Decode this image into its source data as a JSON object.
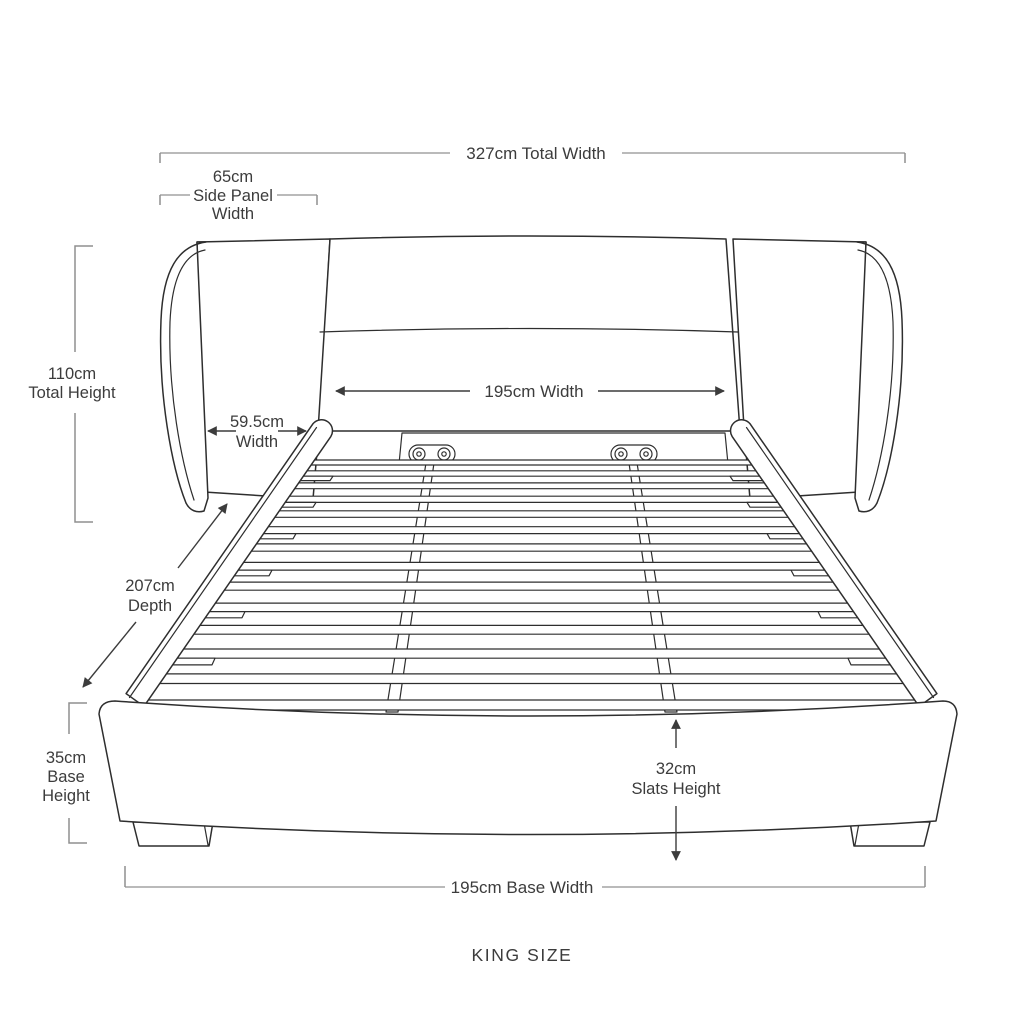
{
  "colors": {
    "background": "#ffffff",
    "ink": "#2e2e2e",
    "dim": "#8f8f8f",
    "dimLight": "#b0b0b0",
    "label": "#3c3c3c"
  },
  "diagram": {
    "product_label": "KING SIZE",
    "dimensions": {
      "total_width": "327cm Total Width",
      "side_panel_width": [
        "65cm",
        "Side Panel",
        "Width"
      ],
      "total_height": [
        "110cm",
        "Total Height"
      ],
      "headboard_width": "195cm Width",
      "panel_width": [
        "59.5cm",
        "Width"
      ],
      "depth": [
        "207cm",
        "Depth"
      ],
      "base_height": [
        "35cm",
        "Base",
        "Height"
      ],
      "slats_height": [
        "32cm",
        "Slats Height"
      ],
      "base_width": "195cm Base Width"
    }
  }
}
